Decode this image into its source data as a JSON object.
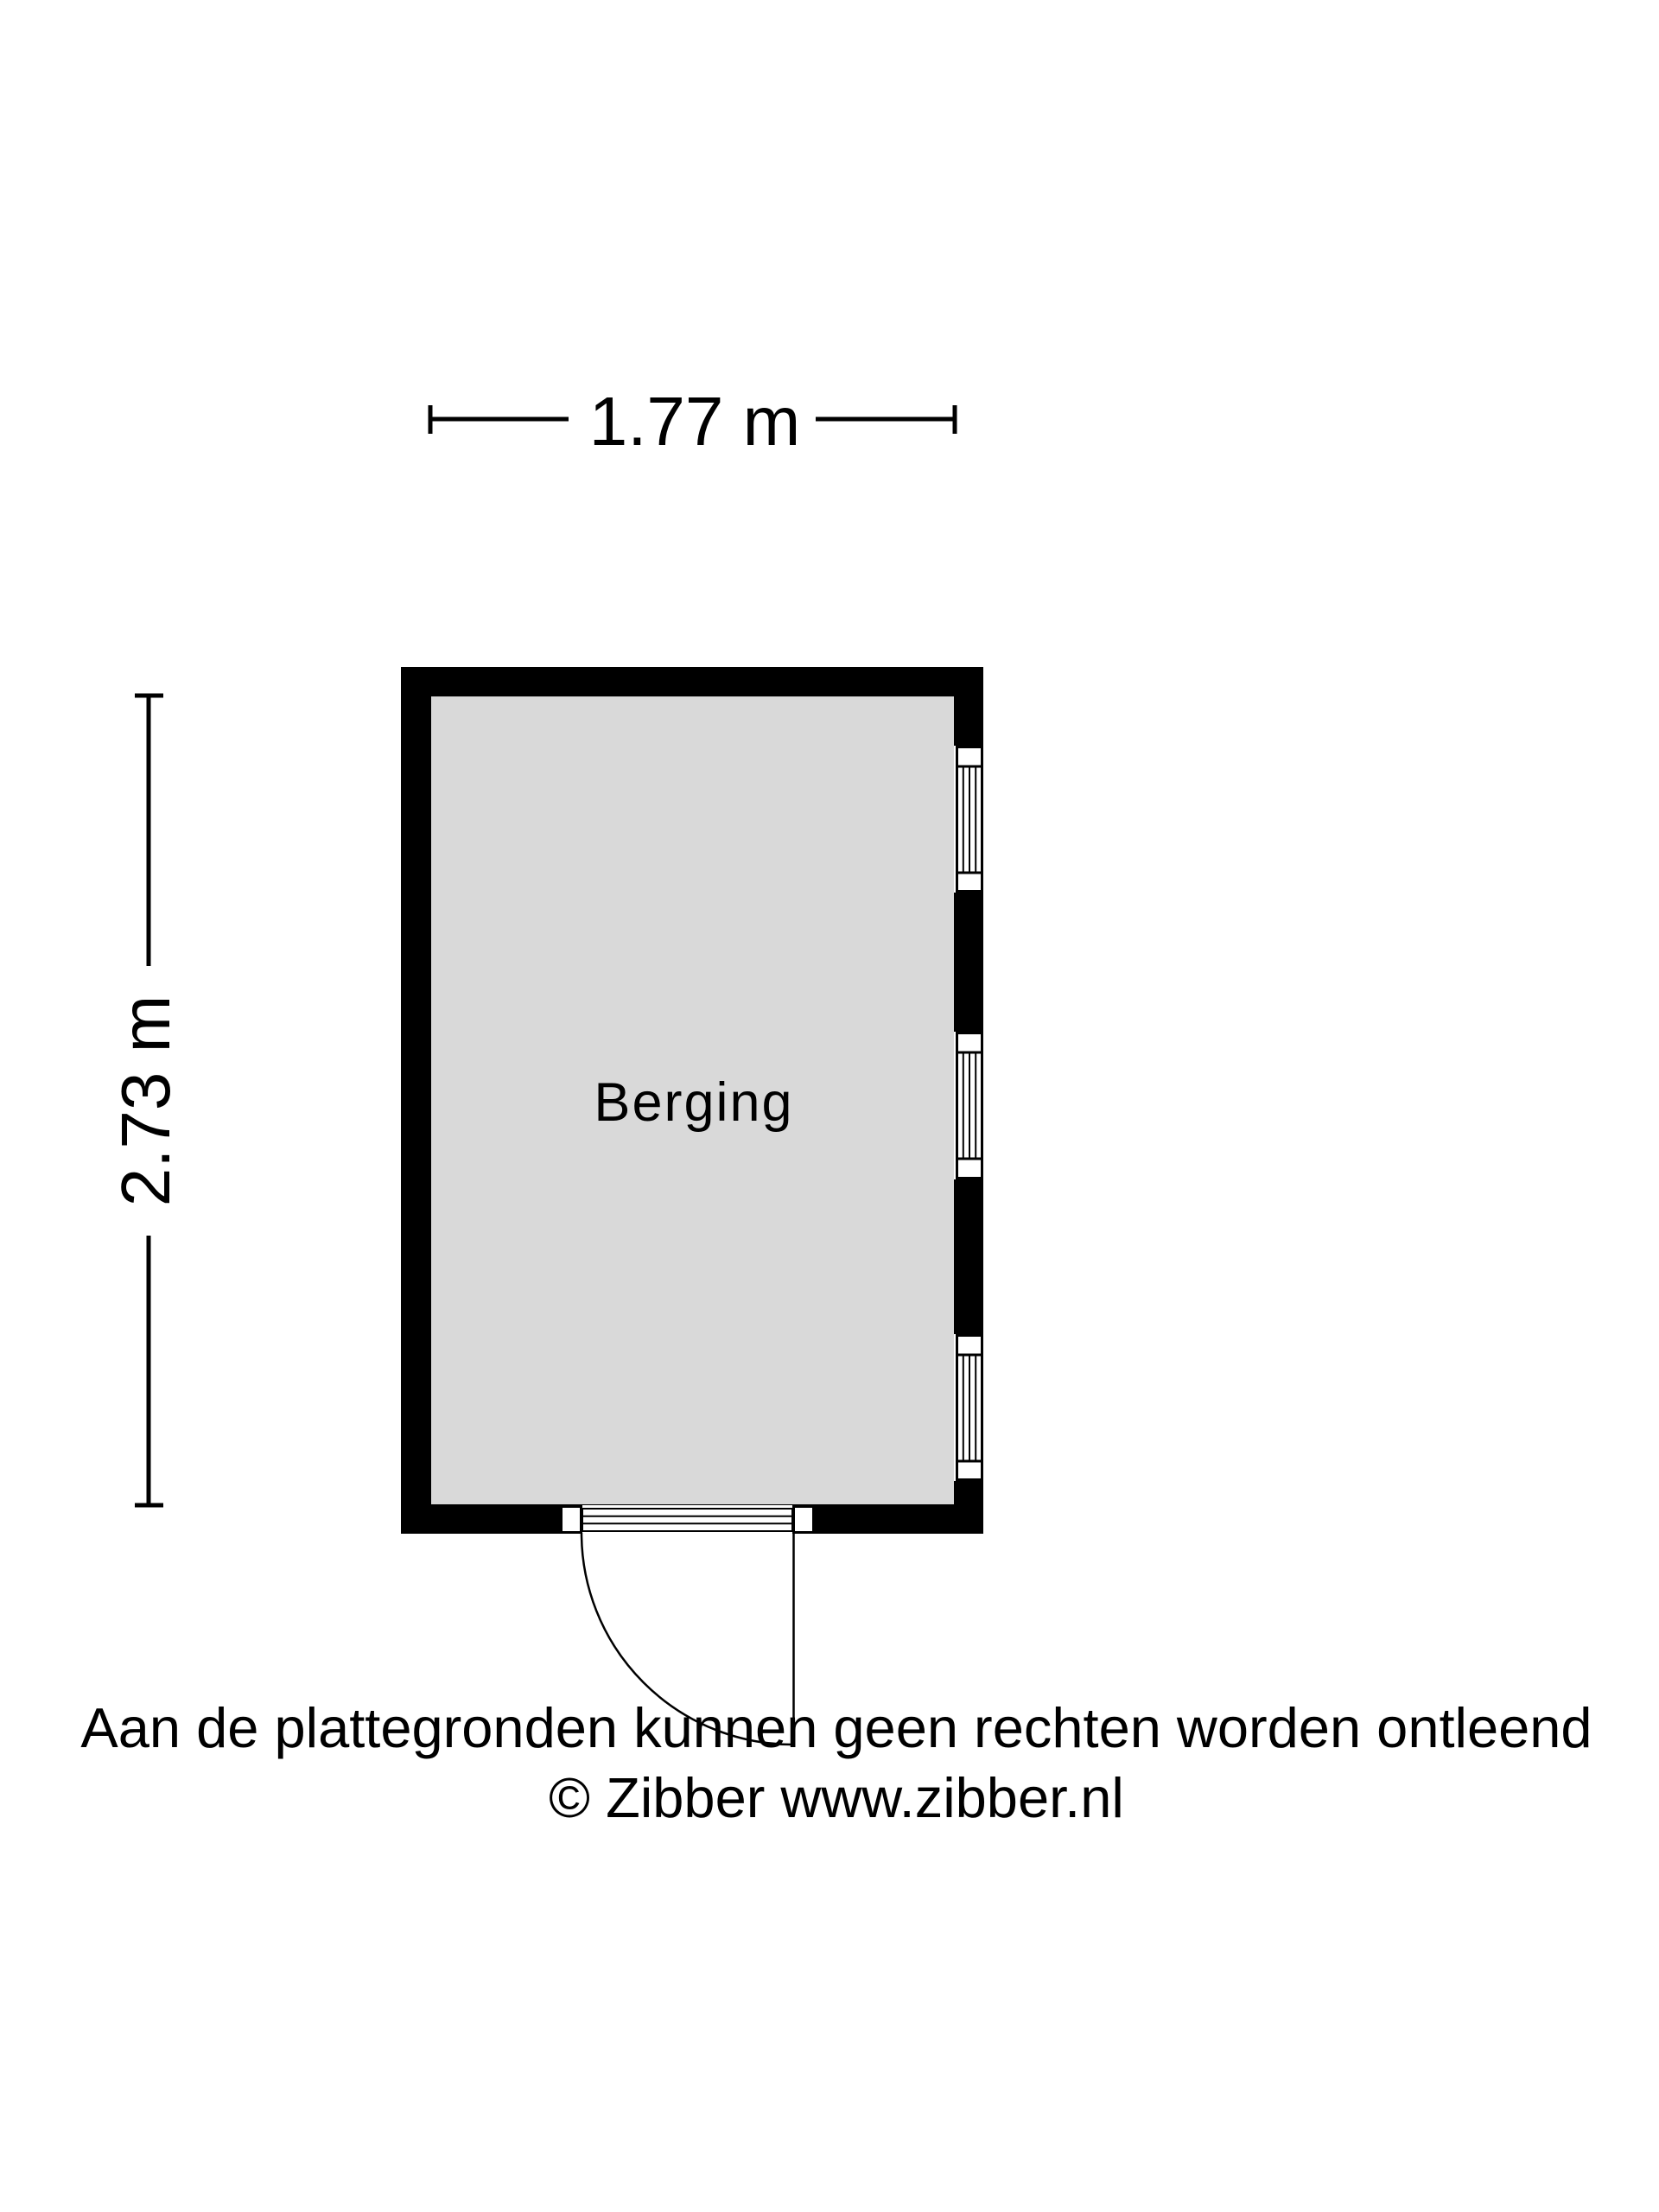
{
  "plan": {
    "room": {
      "label": "Berging",
      "floor_fill": "#d9d9d9",
      "wall_color": "#000000",
      "line_color": "#000000"
    },
    "dimensions": {
      "width_label": "1.77 m",
      "height_label": "2.73 m"
    },
    "features": {
      "windows_right_wall": 3,
      "door_bottom_wall": 1,
      "door_swing": "quarter-circle outward, hinge right"
    }
  },
  "footer": {
    "disclaimer": "Aan de plattegronden kunnen geen rechten worden ontleend",
    "copyright": "© Zibber www.zibber.nl"
  }
}
